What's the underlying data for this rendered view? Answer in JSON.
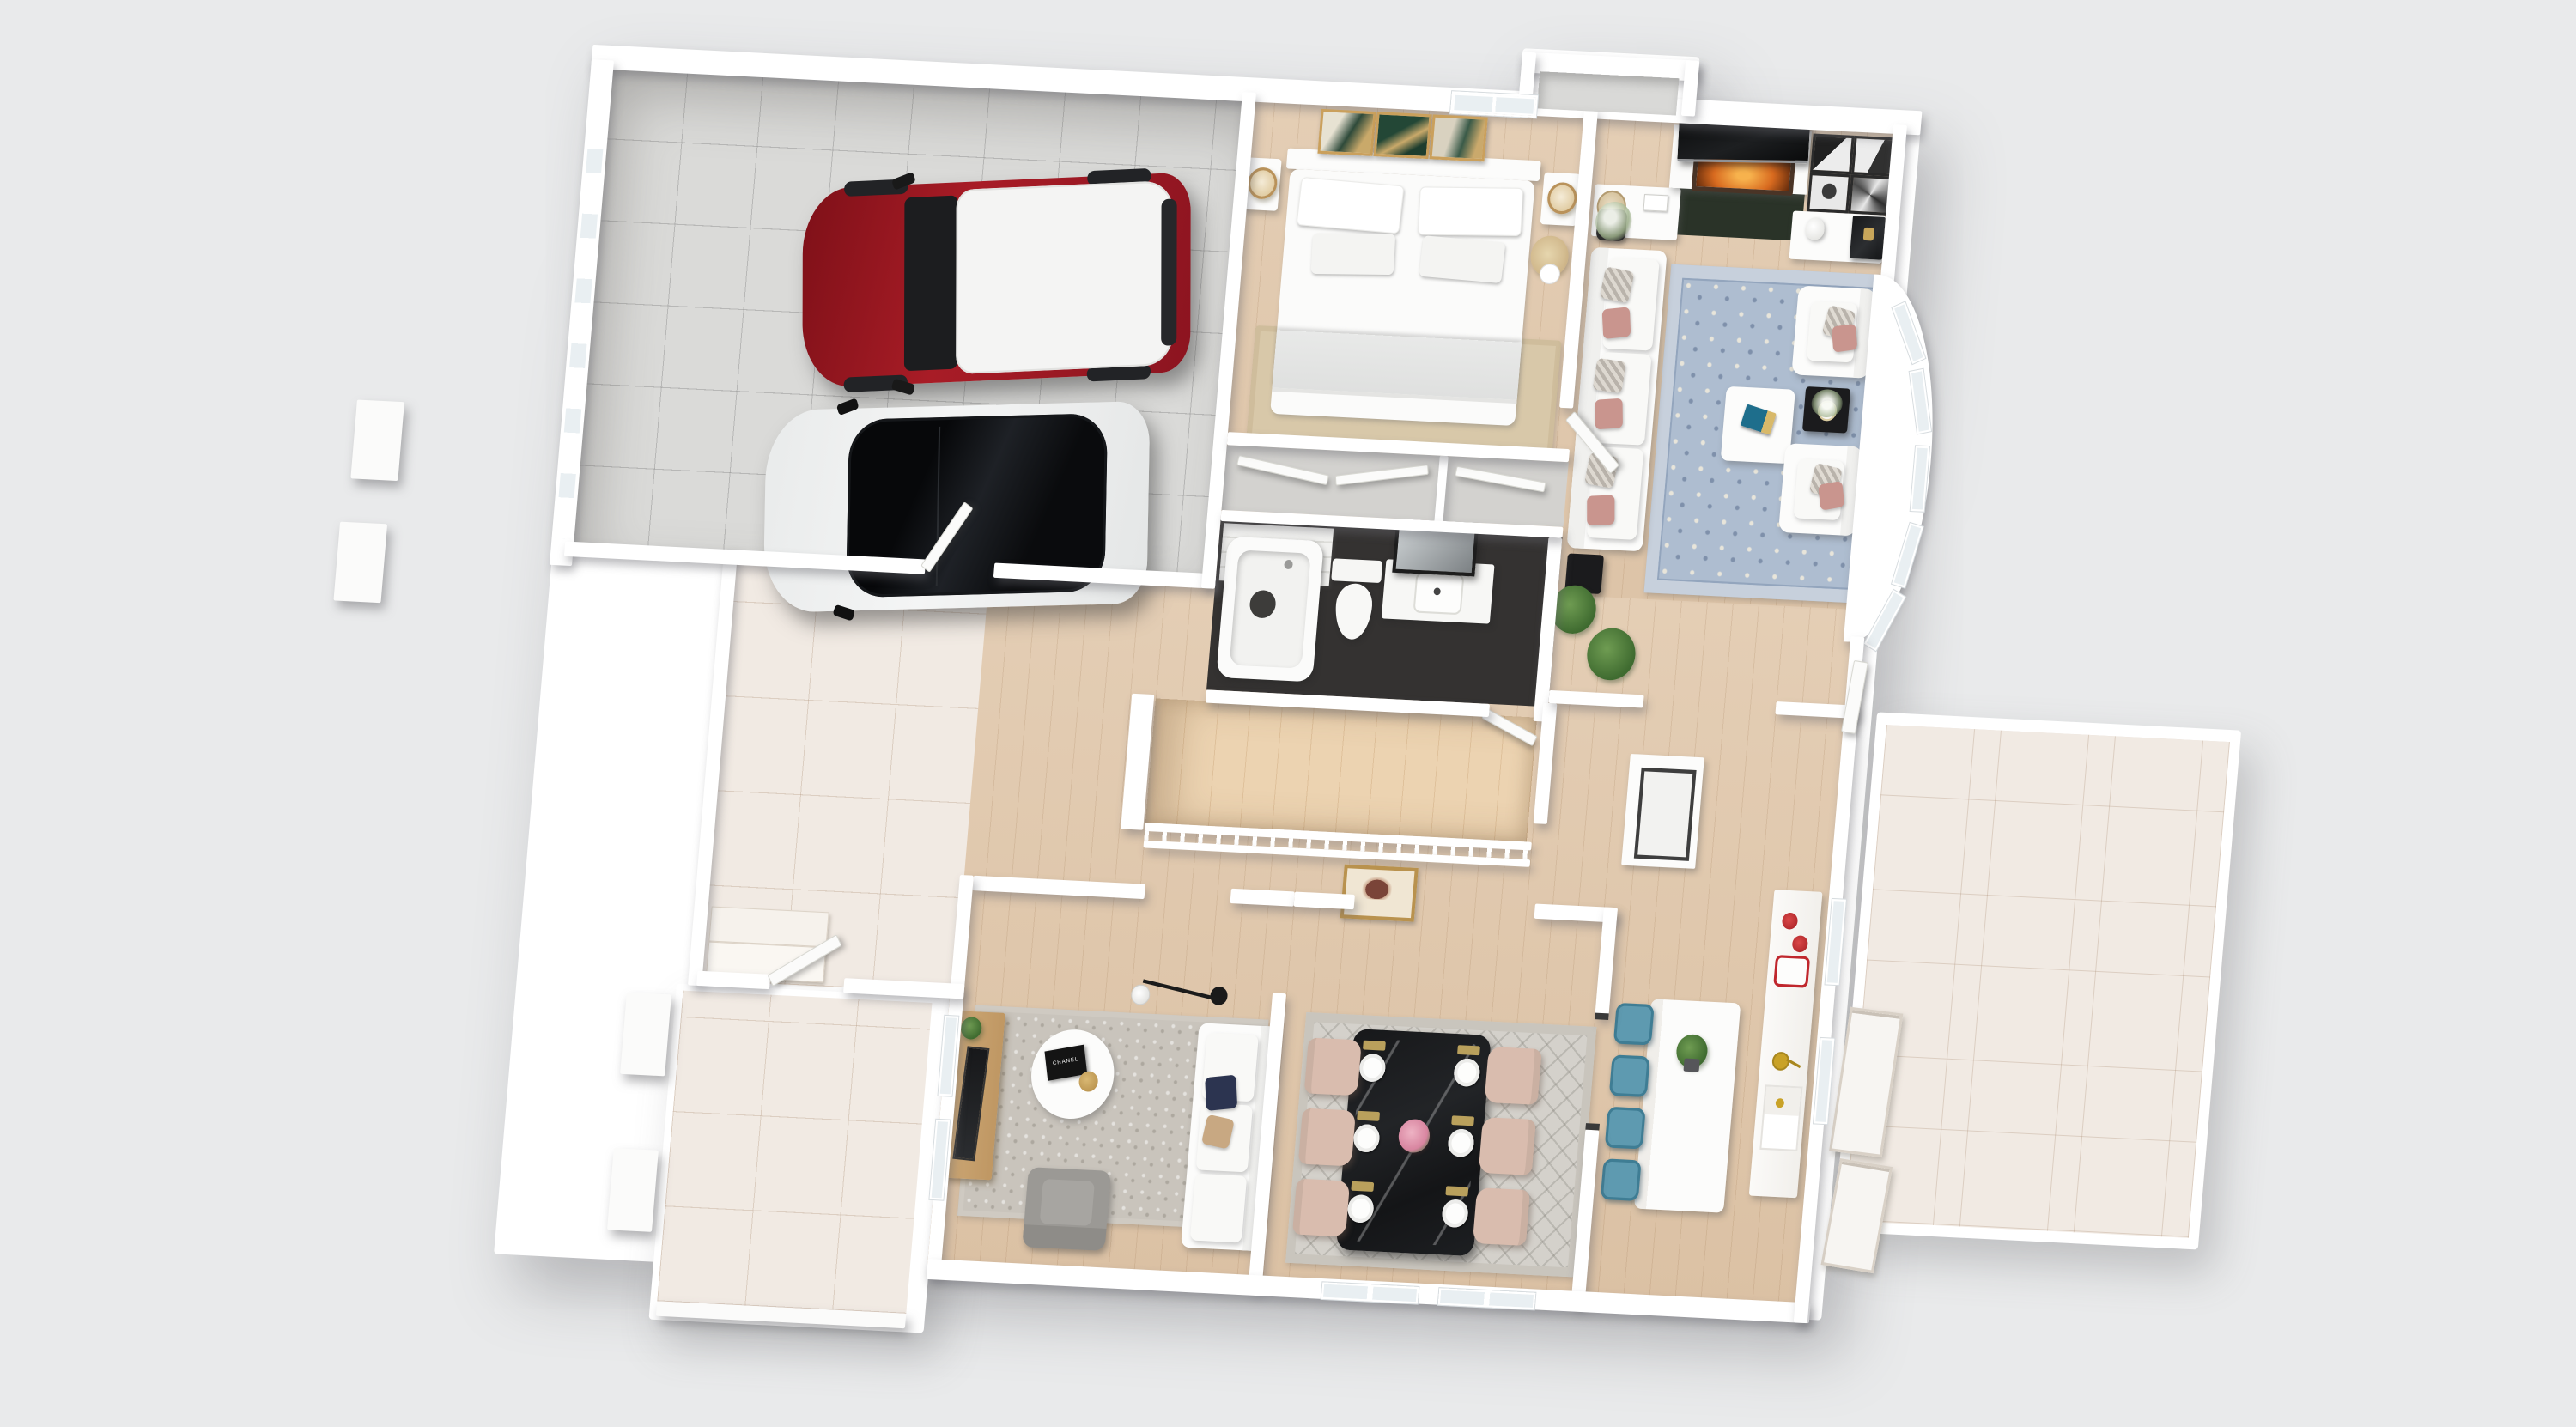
{
  "scene": {
    "type": "3d-dollhouse-floor-plan-rendering",
    "view": "top-down isometric, single storey, white walls on light gray background",
    "background_color": "#e9eaeb",
    "wall_color": "#ffffff",
    "wood_floor_color": "#e0c8ad",
    "garage_tile_color": "#dadad8",
    "outdoor_tile_color": "#f1eae3"
  },
  "rooms": {
    "garage": {
      "label": "Garage",
      "floor": "gray ceramic tile",
      "contents": [
        "red SUV with white roof",
        "white car with black panoramic roof",
        "garage door with window panels",
        "door to foyer"
      ]
    },
    "bedroom": {
      "label": "Bedroom",
      "contents": [
        "double bed with white bedding",
        "2 nightstands",
        "2 gold table lamps",
        "3 framed green-gold artworks",
        "window",
        "pampas grass plant",
        "tan rug",
        "double-door closet"
      ]
    },
    "bathroom": {
      "label": "Bathroom",
      "contents": [
        "bathtub with subway tile wall",
        "toilet",
        "vanity with sink",
        "leaning mirror"
      ],
      "floor_color": "#343231"
    },
    "hallway": {
      "label": "Hallway & Stairs",
      "contents": [
        "staircase with wooden treads",
        "white spindle railing",
        "gold framed abstract artwork",
        "open door"
      ]
    },
    "living_room": {
      "label": "Living Room",
      "contents": [
        "fireplace with fire",
        "flat TV above mantel",
        "dark green hearth rug",
        "2 white dressers",
        "drum lamp",
        "4 black-and-white framed artworks",
        "white bust sculpture",
        "black marble console",
        "white sofa with gray and blush pillows",
        "2 white armchairs",
        "blue persian rug",
        "white coffee table with teal book",
        "black side tables",
        "vase of baby's breath",
        "potted palm",
        "curved bay window wall",
        "patio door"
      ],
      "bay_window_panels": 5
    },
    "foyer": {
      "label": "Foyer",
      "contents": [
        "beige tile floor",
        "entry steps",
        "front door"
      ]
    },
    "family_room": {
      "label": "Family Room",
      "contents": [
        "wood media console with plant and leaning TV panel",
        "white sofa with navy and tan pillows",
        "gray armchair",
        "round white coffee table",
        "black book",
        "gourd vase",
        "black arc floor lamp",
        "2 windows",
        "gray rug"
      ],
      "book_title": "CHANEL"
    },
    "dining_room": {
      "label": "Dining Room",
      "chairs": 6,
      "place_settings": 6,
      "contents": [
        "black marble dining table",
        "6 blush upholstered chairs",
        "6 white place settings with gold napkins",
        "pink flower centerpiece",
        "gray diamond-pattern rug",
        "2 front windows",
        "dark framed opening to kitchen"
      ]
    },
    "kitchen": {
      "label": "Kitchen",
      "stools": 4,
      "contents": [
        "white quartz island with potted plant",
        "4 teal-blue metal bar stools",
        "perimeter counter",
        "red cookware",
        "gold pan",
        "sink niche with gold faucet",
        "pantry cabinet",
        "2 windows"
      ]
    },
    "porch": {
      "label": "Front Porch",
      "contents": [
        "beige tile",
        "2 white wall stubs",
        "entry step"
      ]
    },
    "patio": {
      "label": "Patio",
      "contents": [
        "beige tile",
        "leaning white window frames"
      ]
    },
    "exterior": {
      "label": "Exterior",
      "contents": [
        "chimney bump-out",
        "detached wall stubs left of garage"
      ]
    }
  },
  "vehicles": [
    {
      "name": "red-suv",
      "body_color": "#9e1822",
      "roof_color": "#f4f4f3",
      "position": "garage upper bay"
    },
    {
      "name": "white-car-black-roof",
      "body_color": "#eff0f0",
      "roof_color": "#121316",
      "position": "garage lower bay"
    }
  ],
  "palette": {
    "accent_fire": "#e08a2f",
    "rug_blue": "#aebdd0",
    "dining_table_black": "#1b1c1e",
    "chair_blush": "#d9bcae",
    "stool_teal": "#5e9ab0",
    "pillow_pink": "#c9958e",
    "pillow_navy": "#2c3450",
    "stair_tread": "#e8cfad",
    "frame_gold": "#b9924e"
  }
}
